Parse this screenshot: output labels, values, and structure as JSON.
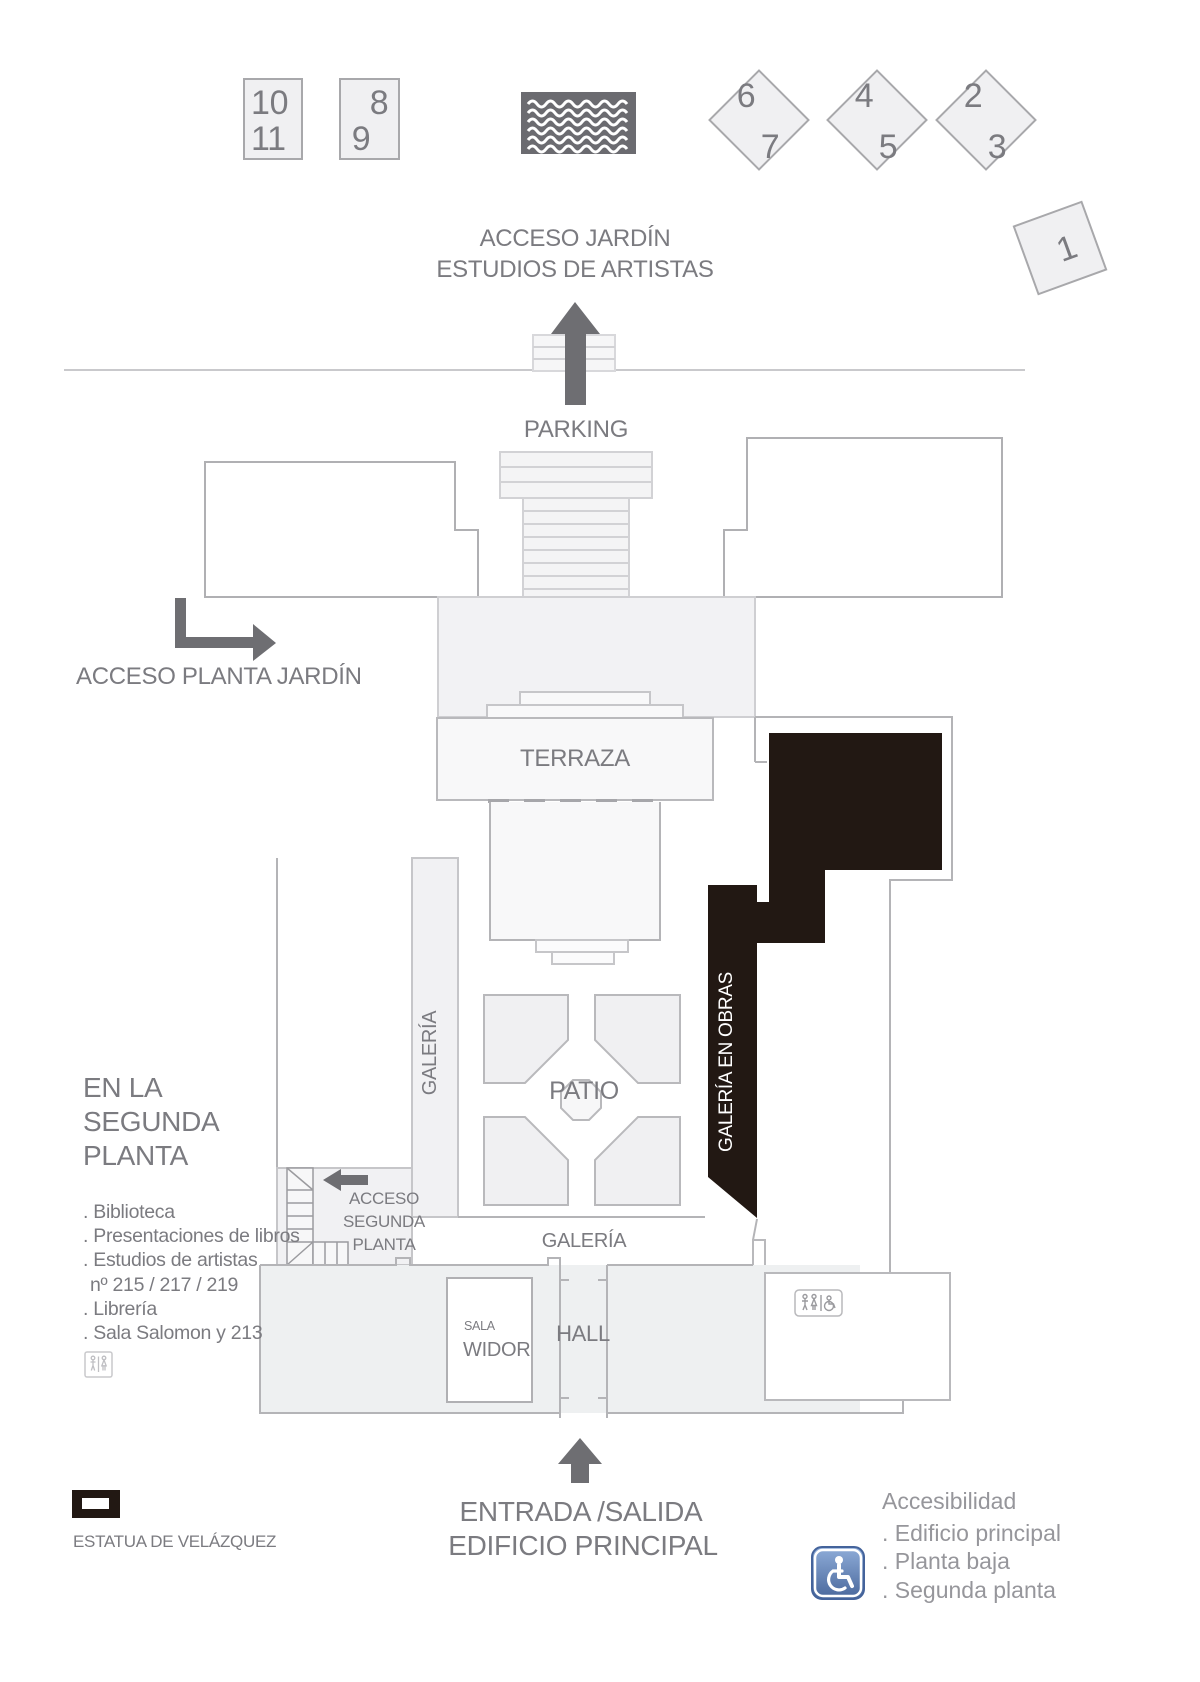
{
  "legend": {
    "box_10_11": [
      "10",
      "11"
    ],
    "box_8_9": [
      "8",
      "9"
    ],
    "diamond_6_7": [
      "6",
      "7"
    ],
    "diamond_4_5": [
      "4",
      "5"
    ],
    "diamond_2_3": [
      "2",
      "3"
    ],
    "tile_1": "1",
    "pool_icon": "water-waves-icon"
  },
  "top": {
    "acceso_jardin_line1": "ACCESO JARDÍN",
    "acceso_jardin_line2": "ESTUDIOS DE ARTISTAS",
    "parking": "PARKING"
  },
  "west": {
    "acceso_planta_jardin": "ACCESO PLANTA JARDÍN"
  },
  "plan": {
    "terraza": "TERRAZA",
    "patio": "PATIO",
    "galeria_west": "GALERÍA",
    "galeria_obras": "GALERÍA EN OBRAS",
    "galeria_south": "GALERÍA",
    "hall": "HALL",
    "sala": "SALA",
    "widor": "WIDOR",
    "acceso_segunda": [
      "ACCESO",
      "SEGUNDA",
      "PLANTA"
    ]
  },
  "second_floor": {
    "title": [
      "EN LA",
      "SEGUNDA",
      "PLANTA"
    ],
    "items": [
      ". Biblioteca",
      ". Presentaciones de libros",
      ". Estudios de artistas",
      "nº 215 / 217 / 219",
      ". Librería",
      ". Sala Salomon y 213"
    ]
  },
  "statue": {
    "label": "ESTATUA DE VELÁZQUEZ"
  },
  "entrance": {
    "line1": "ENTRADA /SALIDA",
    "line2": "EDIFICIO PRINCIPAL"
  },
  "accessibility": {
    "title": "Accesibilidad",
    "items": [
      ". Edificio principal",
      ". Planta baja",
      ". Segunda planta"
    ]
  },
  "colors": {
    "closed_gallery": "#221813",
    "outline": "#b4b4b7",
    "light_fill": "#f1f1f3",
    "label_ink": "#7b7b80",
    "accessibility_blue": "#4a6fa8",
    "pool_gray": "#6b6b70"
  }
}
